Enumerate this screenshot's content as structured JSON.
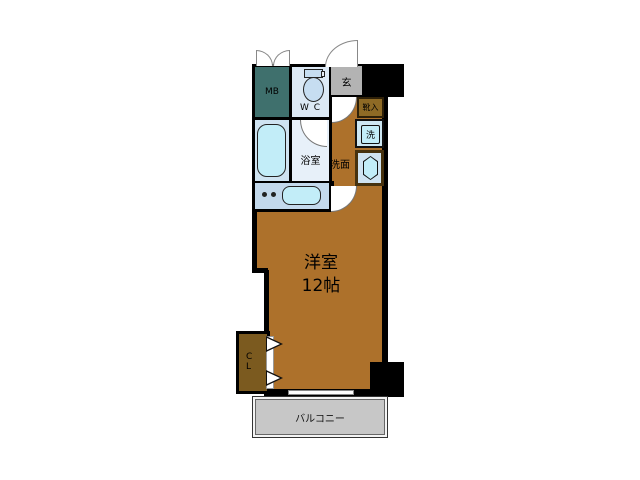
{
  "floor_plan": {
    "rooms": {
      "meter_box": {
        "label": "MB"
      },
      "toilet": {
        "label": "W C"
      },
      "entrance": {
        "label": "玄"
      },
      "shoe_cabinet": {
        "label": "靴入"
      },
      "washing_machine": {
        "label": "洗"
      },
      "washroom": {
        "label": "洗面"
      },
      "bathroom": {
        "label": "浴室"
      },
      "closet": {
        "label_line1": "C",
        "label_line2": "L"
      },
      "main_room": {
        "name": "洋室",
        "size": "12帖"
      },
      "balcony": {
        "label": "バルコニー"
      }
    },
    "colors": {
      "wall": "#000000",
      "room_brown": "#ad712b",
      "closet_brown": "#7b5a1f",
      "shoe_brown": "#8e6a25",
      "mb_teal": "#3f706d",
      "entrance_gray": "#b3b3b3",
      "balcony_gray": "#c7c7c7",
      "wc_blue": "#dce9f5",
      "tub_room_blue": "#cfe3f1",
      "bathroom_pale": "#e7f0f9",
      "kitchen_blue": "#c3d9ec",
      "washer_bg": "#cde7f3",
      "fixture_aqua": "#c2edf8"
    }
  }
}
